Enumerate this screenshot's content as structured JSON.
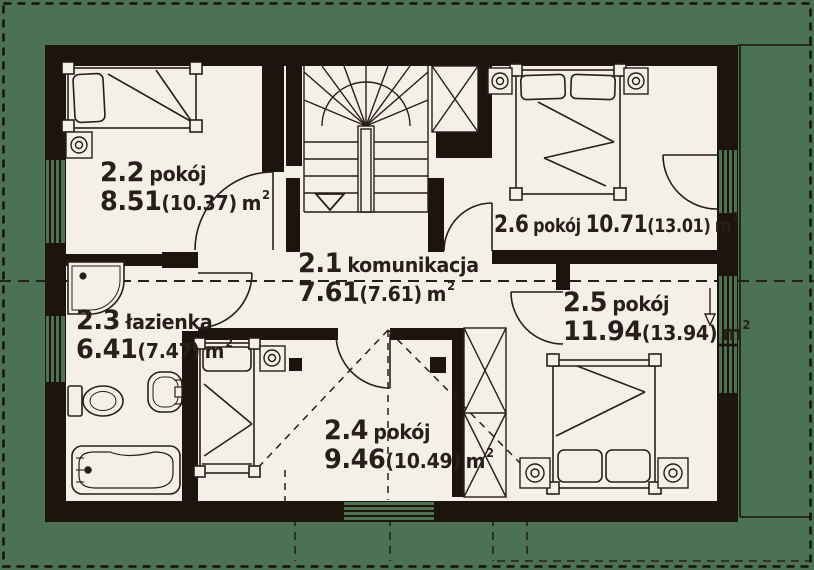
{
  "plan_title": "attic floor plan",
  "units": {
    "symbol": "m",
    "exponent": "2"
  },
  "rooms": [
    {
      "id": "2.1",
      "type": "komunikacja",
      "net": "7.61",
      "gross": "(7.61)"
    },
    {
      "id": "2.2",
      "type": "pokój",
      "net": "8.51",
      "gross": "(10.37)"
    },
    {
      "id": "2.3",
      "type": "łazienka",
      "net": "6.41",
      "gross": "(7.47)"
    },
    {
      "id": "2.4",
      "type": "pokój",
      "net": "9.46",
      "gross": "(10.49)"
    },
    {
      "id": "2.5",
      "type": "pokój",
      "net": "11.94",
      "gross": "(13.94)"
    },
    {
      "id": "2.6",
      "type": "pokój",
      "net": "10.71",
      "gross": "(13.01)"
    }
  ],
  "colors": {
    "background_green": "#4b7253",
    "floor_cream": "#f4efe8",
    "wall_black": "#1d140c",
    "line": "#281f17"
  },
  "symbols": [
    "staircase-winder",
    "wardrobe-x-brace",
    "double-bed",
    "single-bed",
    "nightstand-lamp",
    "bathtub",
    "toilet",
    "washbasin",
    "corner-shower",
    "door-swing-arc",
    "window-band",
    "roof-ridge-dashed-line",
    "down-arrow"
  ]
}
